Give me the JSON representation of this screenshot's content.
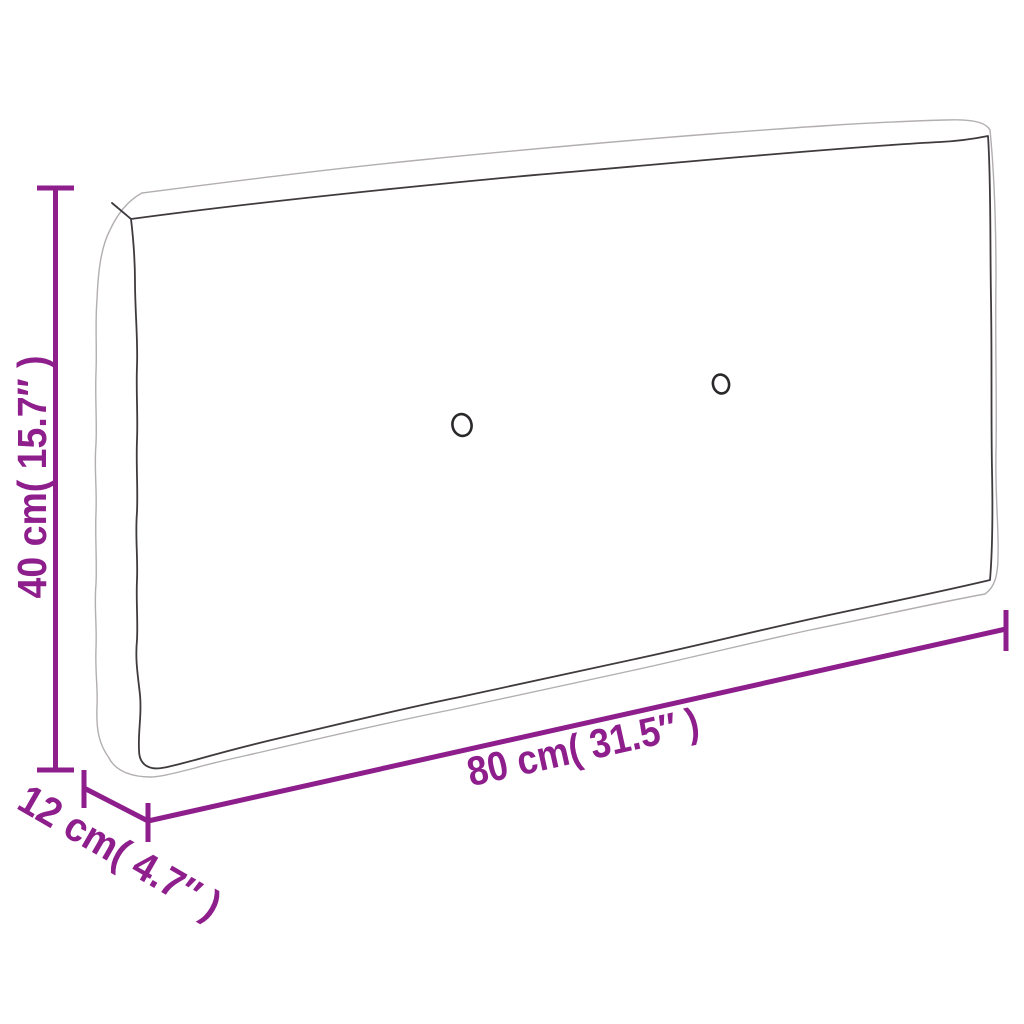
{
  "diagram": {
    "accent_color": "#8D1E8C",
    "outline_light_color": "#B2AEB2",
    "outline_dark_color": "#3E3A3E",
    "dimensions": {
      "height": {
        "value_cm": "40",
        "value_inch": "15.7",
        "label": "40 cm( 15.7″ )"
      },
      "length": {
        "value_cm": "80",
        "value_inch": "31.5",
        "label": "80 cm( 31.5″ )"
      },
      "depth": {
        "value_cm": "12",
        "value_inch": "4.7",
        "label": "12 cm( 4.7″ )"
      }
    }
  }
}
